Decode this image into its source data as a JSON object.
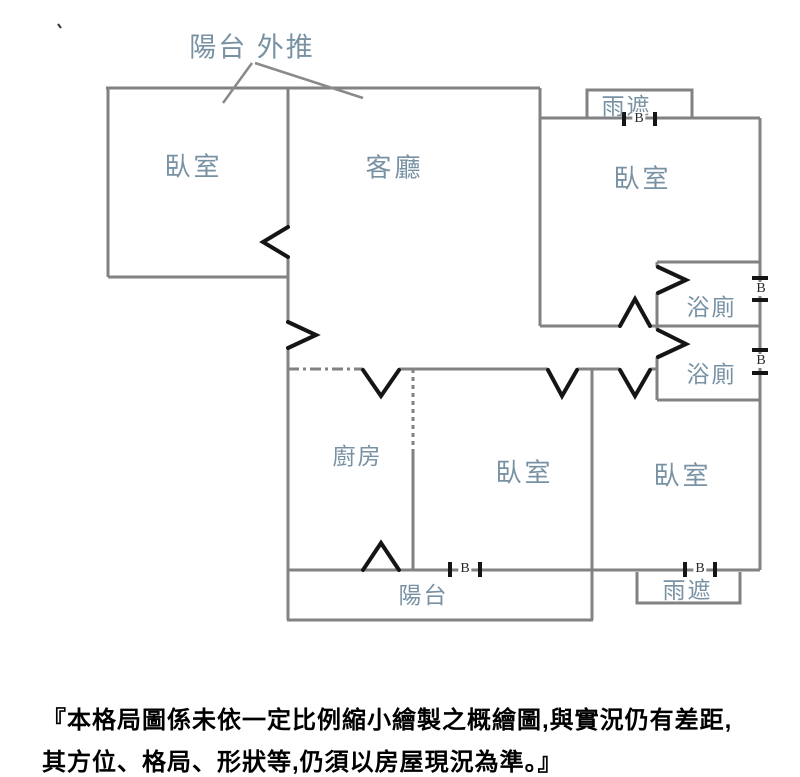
{
  "floorplan": {
    "annotation": {
      "label": "陽台 外推"
    },
    "rooms": [
      {
        "name": "bedroom-top-left",
        "label": "臥室"
      },
      {
        "name": "living-room",
        "label": "客廳"
      },
      {
        "name": "bedroom-top-right",
        "label": "臥室"
      },
      {
        "name": "bathroom-upper",
        "label": "浴廁"
      },
      {
        "name": "bathroom-lower",
        "label": "浴廁"
      },
      {
        "name": "kitchen",
        "label": "廚房"
      },
      {
        "name": "bedroom-bottom-left",
        "label": "臥室"
      },
      {
        "name": "bedroom-bottom-right",
        "label": "臥室"
      },
      {
        "name": "balcony",
        "label": "陽台"
      },
      {
        "name": "rain-canopy-top",
        "label": "雨遮"
      },
      {
        "name": "rain-canopy-bottom",
        "label": "雨遮"
      }
    ],
    "window_markers": [
      {
        "name": "window-bedroom-top-right",
        "label": "B"
      },
      {
        "name": "window-bathroom-upper",
        "label": "B"
      },
      {
        "name": "window-bathroom-lower",
        "label": "B"
      },
      {
        "name": "window-balcony-wall",
        "label": "B"
      },
      {
        "name": "window-bedroom-bottom-right",
        "label": "B"
      }
    ]
  },
  "disclaimer": {
    "line1": "『本格局圖係未依一定比例縮小繪製之概繪圖,與實況仍有差距,",
    "line2": "其方位、格局、形狀等,仍須以房屋現況為準。』"
  },
  "colors": {
    "wall": "#828282",
    "door_symbol": "#151515",
    "room_label": "#7892a4",
    "disclaimer_text": "#000000",
    "background": "#ffffff"
  }
}
